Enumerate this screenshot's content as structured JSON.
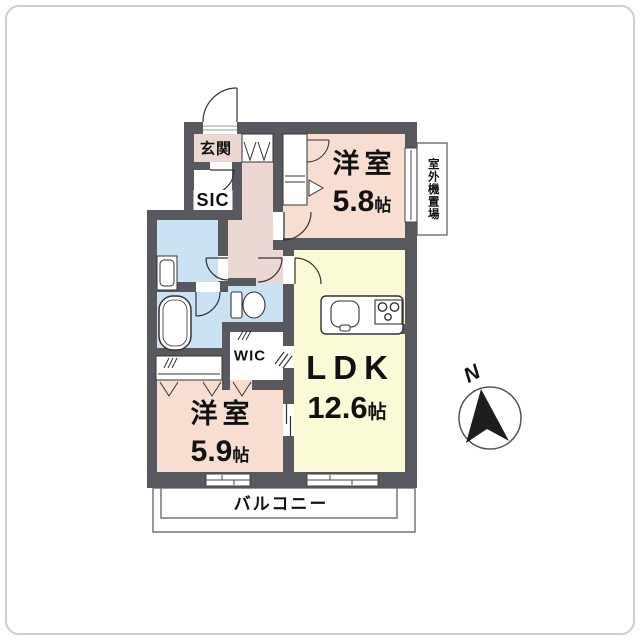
{
  "floorplan": {
    "labels": {
      "entrance": "玄関",
      "sic": "SIC",
      "wic": "WIC",
      "balcony": "バルコニー",
      "outdoor_unit": "室外機置場",
      "compass_north": "N"
    },
    "rooms": {
      "bedroom1": {
        "name": "洋室",
        "size": "5.8",
        "unit": "帖"
      },
      "bedroom2": {
        "name": "洋室",
        "size": "5.9",
        "unit": "帖"
      },
      "ldk": {
        "name": "LDK",
        "size": "12.6",
        "unit": "帖"
      }
    },
    "colors": {
      "wall": "#58585f",
      "hall_pink": "#ecd8d3",
      "bedroom_peach": "#f7ded1",
      "ldk_yellow": "#fafad6",
      "water_blue": "#c9e3f4",
      "fixture_white": "#ffffff",
      "frame_gray": "#cfcfcf",
      "text": "#111111"
    }
  }
}
